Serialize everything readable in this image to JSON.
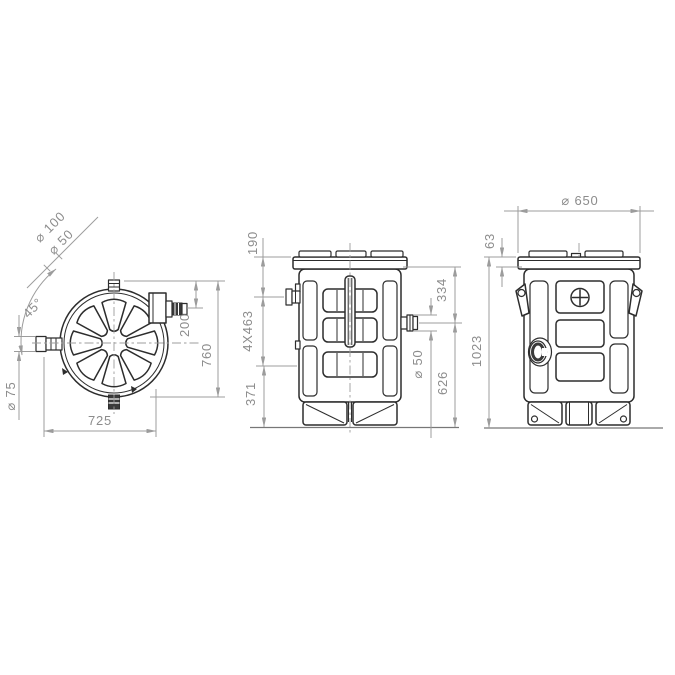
{
  "colors": {
    "background": "#ffffff",
    "drawing_line": "#2d2d2d",
    "dimension_line": "#9c9c9c",
    "dimension_text": "#8c8c8c",
    "dark_fill": "#3a3a3a"
  },
  "views": {
    "top": {
      "dims": {
        "inlet_dia_outer": "⌀ 100",
        "inlet_dia_inner": "⌀ 50",
        "inlet_angle": "45°",
        "side_outlet_dia": "⌀ 75",
        "overall_width": "725",
        "outlet_offset": "200",
        "overall_depth": "760"
      }
    },
    "front": {
      "dims": {
        "inlet_height": "190",
        "rib_spacing": "4X463",
        "base_height": "371",
        "outlet_offset": "334",
        "outlet_dia": "⌀ 50",
        "outlet_height": "626"
      }
    },
    "side": {
      "dims": {
        "body_dia": "⌀ 650",
        "cover_height": "63",
        "overall_height": "1023"
      }
    }
  }
}
